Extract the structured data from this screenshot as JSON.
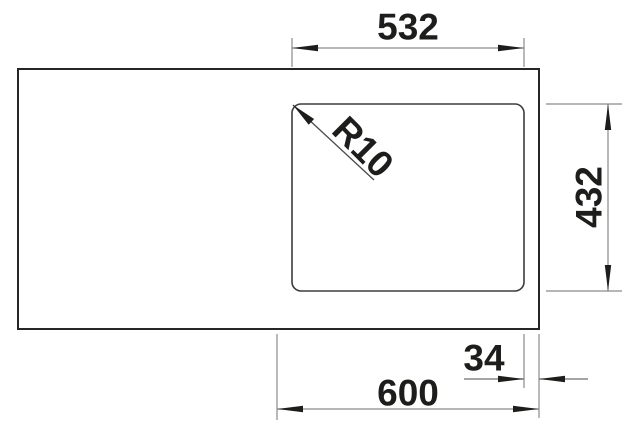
{
  "drawing": {
    "title": "sink-top-view-dimension-drawing",
    "dimensions": {
      "top_width": "532",
      "right_height": "432",
      "bottom_width": "600",
      "edge_offset": "34",
      "corner_radius": "R10"
    },
    "colors": {
      "outline": "#262626",
      "bowl_outline": "#3d3d3d",
      "thin_line": "#8a8a8a",
      "arrow_and_text": "#1d1d1b",
      "background": "#ffffff"
    }
  }
}
